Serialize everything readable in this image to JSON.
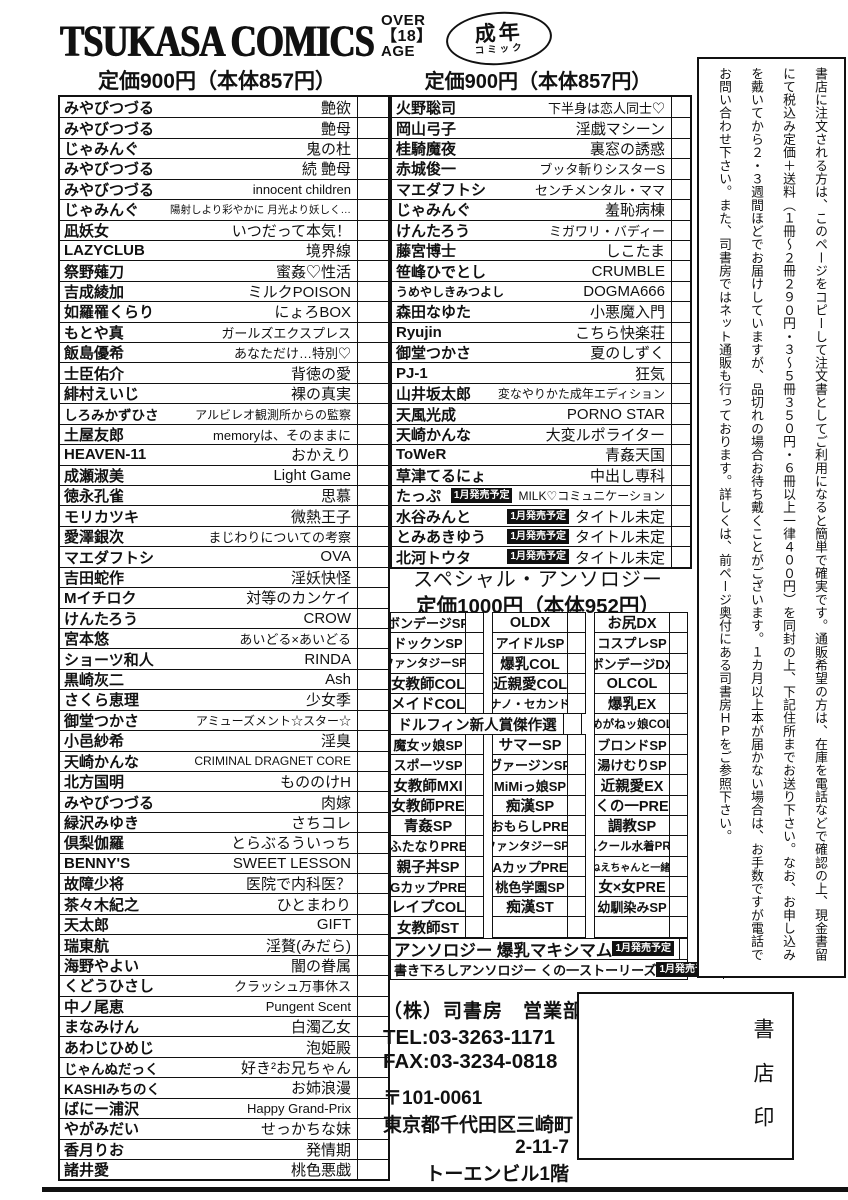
{
  "header": {
    "logo": "TSUKASA COMICS",
    "age_rating": {
      "l1": "OVER",
      "l2": "【18】",
      "l3": "AGE"
    },
    "seinen_badge": {
      "line1": "成年",
      "line2": "コミック"
    },
    "price_left": "定価900円（本体857円）",
    "price_mid": "定価900円（本体857円）"
  },
  "left_list": [
    {
      "author": "みやびつづる",
      "title": "艶欲"
    },
    {
      "author": "みやびつづる",
      "title": "艶母"
    },
    {
      "author": "じゃみんぐ",
      "title": "鬼の杜"
    },
    {
      "author": "みやびつづる",
      "title": "続 艶母"
    },
    {
      "author": "みやびつづる",
      "title": "innocent children"
    },
    {
      "author": "じゃみんぐ",
      "title": "陽射しより彩やかに 月光より妖しく…"
    },
    {
      "author": "凪妖女",
      "title": "いつだって本気！"
    },
    {
      "author": "LAZYCLUB",
      "title": "境界線"
    },
    {
      "author": "祭野薙刀",
      "title": "蜜姦♡性活"
    },
    {
      "author": "吉成綾加",
      "title": "ミルクPOISON"
    },
    {
      "author": "如羅罹くらり",
      "title": "にょろBOX"
    },
    {
      "author": "もとや真",
      "title": "ガールズエクスプレス"
    },
    {
      "author": "飯島優希",
      "title": "あなただけ…特別♡"
    },
    {
      "author": "士臣佑介",
      "title": "背徳の愛"
    },
    {
      "author": "緋村えいじ",
      "title": "裸の真実"
    },
    {
      "author": "しろみかずひさ",
      "title": "アルビレオ観測所からの監察"
    },
    {
      "author": "土屋友郎",
      "title": "memoryは、そのままに"
    },
    {
      "author": "HEAVEN-11",
      "title": "おかえり"
    },
    {
      "author": "成瀬淑美",
      "title": "Light Game"
    },
    {
      "author": "徳永孔雀",
      "title": "思慕"
    },
    {
      "author": "モリカツキ",
      "title": "微熱王子"
    },
    {
      "author": "愛澤銀次",
      "title": "まじわりについての考察"
    },
    {
      "author": "マエダフトシ",
      "title": "OVA"
    },
    {
      "author": "吉田蛇作",
      "title": "淫妖快怪"
    },
    {
      "author": "Mイチロク",
      "title": "対等のカンケイ"
    },
    {
      "author": "けんたろう",
      "title": "CROW"
    },
    {
      "author": "宮本悠",
      "title": "あいどる×あいどる"
    },
    {
      "author": "ショーツ和人",
      "title": "RINDA"
    },
    {
      "author": "黒崎灰二",
      "title": "Ash"
    },
    {
      "author": "さくら恵理",
      "title": "少女季"
    },
    {
      "author": "御堂つかさ",
      "title": "アミューズメント☆スター☆"
    },
    {
      "author": "小邑紗希",
      "title": "淫臭"
    },
    {
      "author": "天崎かんな",
      "title": "CRIMINAL DRAGNET CORE"
    },
    {
      "author": "北方国明",
      "title": "もののけH"
    },
    {
      "author": "みやびつづる",
      "title": "肉嫁"
    },
    {
      "author": "緑沢みゆき",
      "title": "さちコレ"
    },
    {
      "author": "倶梨伽羅",
      "title": "とらぶるういっち"
    },
    {
      "author": "BENNY'S",
      "title": "SWEET LESSON"
    },
    {
      "author": "故障少将",
      "title": "医院で内科医？"
    },
    {
      "author": "茶々木紀之",
      "title": "ひとまわり"
    },
    {
      "author": "天太郎",
      "title": "GIFT"
    },
    {
      "author": "瑞東航",
      "title": "淫贅(みだら)"
    },
    {
      "author": "海野やよい",
      "title": "闇の眷属"
    },
    {
      "author": "くどうひさし",
      "title": "クラッシュ万事休ス"
    },
    {
      "author": "中ノ尾恵",
      "title": "Pungent Scent"
    },
    {
      "author": "まなみけん",
      "title": "白濁乙女"
    },
    {
      "author": "あわじひめじ",
      "title": "泡姫殿"
    },
    {
      "author": "じゃんぬだっく",
      "title": "好き²お兄ちゃん"
    },
    {
      "author": "KASHIみちのく",
      "title": "お姉浪漫"
    },
    {
      "author": "ばにー浦沢",
      "title": "Happy Grand-Prix"
    },
    {
      "author": "やがみだい",
      "title": "せっかちな妹"
    },
    {
      "author": "香月りお",
      "title": "発情期"
    },
    {
      "author": "諸井愛",
      "title": "桃色悪戯"
    }
  ],
  "mid_list": [
    {
      "author": "火野聡司",
      "title": "下半身は恋人同士♡"
    },
    {
      "author": "岡山弓子",
      "title": "淫戯マシーン"
    },
    {
      "author": "桂騎魔夜",
      "title": "裏窓の誘惑"
    },
    {
      "author": "赤城俊一",
      "title": "ブッタ斬りシスターS"
    },
    {
      "author": "マエダフトシ",
      "title": "センチメンタル・ママ"
    },
    {
      "author": "じゃみんぐ",
      "title": "羞恥病棟"
    },
    {
      "author": "けんたろう",
      "title": "ミガワリ・バディー"
    },
    {
      "author": "藤宮博士",
      "title": "しこたま"
    },
    {
      "author": "笹峰ひでとし",
      "title": "CRUMBLE"
    },
    {
      "author": "うめやしきみつよし",
      "title": "DOGMA666"
    },
    {
      "author": "森田なゆた",
      "title": "小悪魔入門"
    },
    {
      "author": "Ryujin",
      "title": "こちら快楽荘"
    },
    {
      "author": "御堂つかさ",
      "title": "夏のしずく"
    },
    {
      "author": "PJ-1",
      "title": "狂気"
    },
    {
      "author": "山井坂太郎",
      "title": "変なやりかた成年エディション"
    },
    {
      "author": "天風光成",
      "title": "PORNO STAR"
    },
    {
      "author": "天崎かんな",
      "title": "大変ルポライター"
    },
    {
      "author": "ToWeR",
      "title": "青姦天国"
    },
    {
      "author": "草津てるにょ",
      "title": "中出し専科"
    },
    {
      "author": "たっぷ",
      "badge": "1月発売予定",
      "title": "MILK♡コミュニケーション"
    },
    {
      "author": "水谷みんと",
      "badge": "1月発売予定",
      "title": "タイトル未定"
    },
    {
      "author": "とみあきゆう",
      "badge": "1月発売予定",
      "title": "タイトル未定"
    },
    {
      "author": "北河トウタ",
      "badge": "1月発売予定",
      "title": "タイトル未定"
    }
  ],
  "anthology": {
    "heading": "スペシャル・アンソロジー",
    "price": "定価1000円（本体952円）",
    "grid": [
      {
        "cells": [
          "ボンデージSP",
          "OLDX",
          "お尻DX"
        ]
      },
      {
        "cells": [
          "ドックンSP",
          "アイドルSP",
          "コスプレSP"
        ]
      },
      {
        "cells": [
          "ファンタジーSP2",
          "爆乳COL",
          "ボンデージDX"
        ]
      },
      {
        "cells": [
          "女教師COL",
          "近親愛COL",
          "OLCOL"
        ]
      },
      {
        "cells": [
          "メイドCOL",
          "ナノ・セカンド",
          "爆乳EX"
        ]
      },
      {
        "span2": true,
        "cells": [
          "ドルフィン新人賞傑作選",
          "めがねッ娘COL"
        ]
      },
      {
        "cells": [
          "魔女ッ娘SP",
          "サマーSP",
          "ブロンドSP"
        ]
      },
      {
        "cells": [
          "スポーツSP",
          "ヴァージンSP",
          "湯けむりSP"
        ]
      },
      {
        "cells": [
          "女教師MXI",
          "MiMiっ娘SP",
          "近親愛EX"
        ]
      },
      {
        "cells": [
          "女教師PRE",
          "痴漢SP",
          "くの一PRE"
        ]
      },
      {
        "cells": [
          "青姦SP",
          "おもらしPRE",
          "調教SP"
        ]
      },
      {
        "cells": [
          "ふたなりPRE",
          "ファンタジーSP3",
          "スクール水着PRE"
        ]
      },
      {
        "cells": [
          "親子丼SP",
          "AカップPRE",
          "おねえちゃんと一緒SP"
        ]
      },
      {
        "cells": [
          "GカップPRE",
          "桃色学園SP",
          "女×女PRE"
        ]
      },
      {
        "cells": [
          "レイプCOL",
          "痴漢ST",
          "幼馴染みSP"
        ]
      },
      {
        "cells": [
          "女教師ST",
          "",
          ""
        ]
      }
    ],
    "full_rows": [
      {
        "label": "アンソロジー 爆乳マキシマム",
        "badge": "1月発売予定"
      },
      {
        "label": "書き下ろしアンソロジー くの一ストーリーズ",
        "badge": "1月発売予定"
      }
    ]
  },
  "notice": {
    "columns": [
      "書店に注文される方は、このページをコピーして注文書としてご利用になると簡単で確実です。通販希望の方は、在庫を電話などで確認の上、現金書留",
      "にて税込み定価＋送料（１冊～２冊２９０円・３～５冊３５０円・６冊以上一律４００円）を同封の上、下記住所までお送り下さい。なお、お申し込み",
      "を戴いてから２・３週間ほどでお届けしていますが、品切れの場合お待ち戴くことがございます。１カ月以上本が届かない場合は、お手数ですが電話で",
      "お問い合わせ下さい。また、司書房ではネット通販も行っております。詳しくは、前ページ奥付にある司書房ＨＰをご参照下さい。"
    ]
  },
  "publisher": {
    "name": "（株）司書房　営業部",
    "tel": "TEL:03-3263-1171",
    "fax": "FAX:03-3234-0818",
    "postal": "〒101-0061",
    "address1": "東京都千代田区三崎町",
    "address2": "2-11-7",
    "address3": "トーエンビル1階"
  },
  "stamp_box": {
    "label": "書店印"
  }
}
